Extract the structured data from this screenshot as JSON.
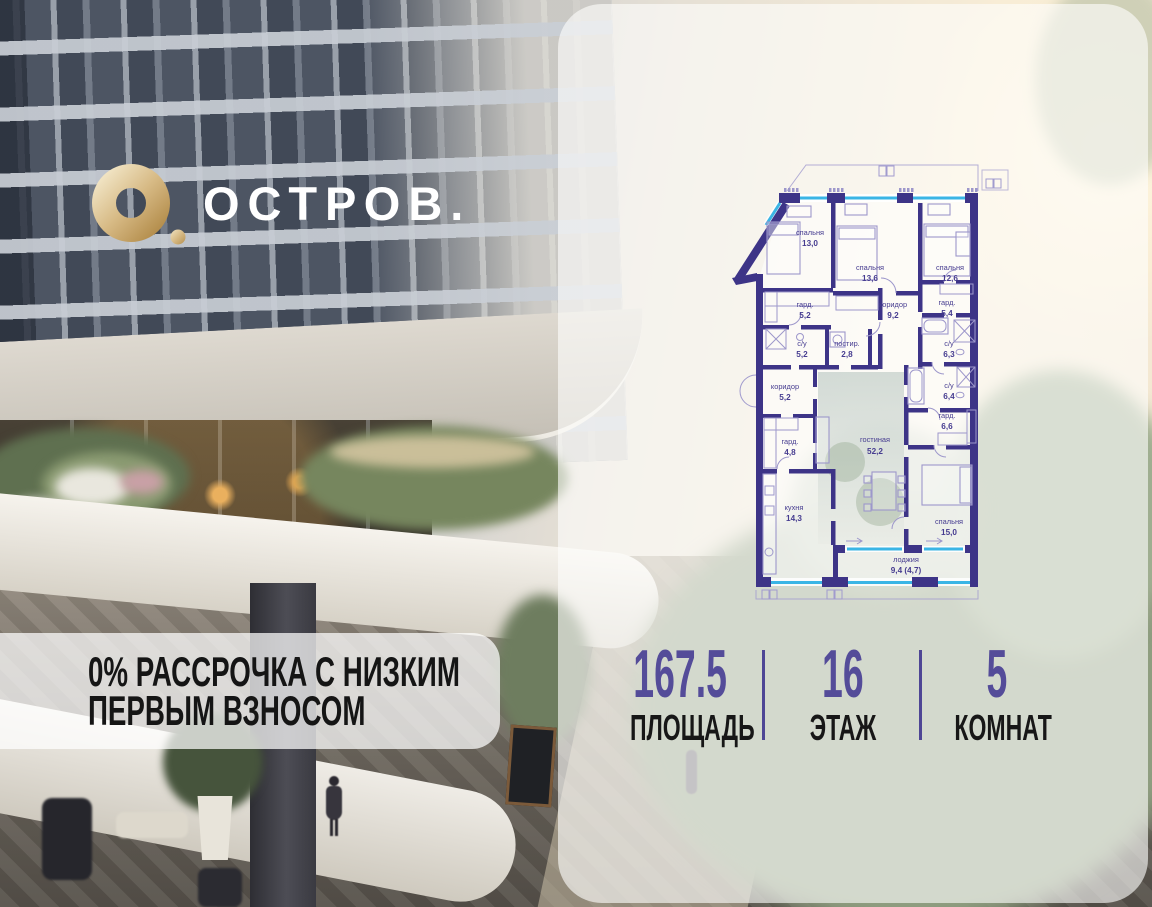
{
  "brand": {
    "name": "ОСТРОВ.",
    "mark": "gold-ring-with-dot"
  },
  "promo": {
    "line1": "0% РАССРОЧКА С НИЗКИМ",
    "line2": "ПЕРВЫМ ВЗНОСОМ"
  },
  "stats": {
    "area": {
      "value": "167.5",
      "label": "ПЛОЩАДЬ"
    },
    "floor": {
      "value": "16",
      "label": "ЭТАЖ"
    },
    "rooms": {
      "value": "5",
      "label": "КОМНАТ"
    }
  },
  "floorplan": {
    "rooms": [
      {
        "name": "спальня",
        "area": "13,0"
      },
      {
        "name": "спальня",
        "area": "13,6"
      },
      {
        "name": "спальня",
        "area": "12,6"
      },
      {
        "name": "гард.",
        "area": "5,2"
      },
      {
        "name": "коридор",
        "area": "9,2"
      },
      {
        "name": "гард.",
        "area": "5,4"
      },
      {
        "name": "с/у",
        "area": "5,2"
      },
      {
        "name": "постир.",
        "area": "2,8"
      },
      {
        "name": "с/у",
        "area": "6,3"
      },
      {
        "name": "коридор",
        "area": "5,2"
      },
      {
        "name": "с/у",
        "area": "6,4"
      },
      {
        "name": "гард.",
        "area": "6,6"
      },
      {
        "name": "гард.",
        "area": "4,8"
      },
      {
        "name": "гостиная",
        "area": "52,2"
      },
      {
        "name": "кухня",
        "area": "14,3"
      },
      {
        "name": "спальня",
        "area": "15,0"
      },
      {
        "name": "лоджия",
        "area": "9,4 (4,7)"
      }
    ],
    "colors": {
      "wall": "#3d3487",
      "window": "#3ab5e5",
      "thin_lines": "#9d97cb"
    }
  },
  "colors": {
    "accent_purple": "#544c99",
    "divider_purple": "#4e4695",
    "gold": "#cfa968",
    "text_dark": "#151515"
  }
}
